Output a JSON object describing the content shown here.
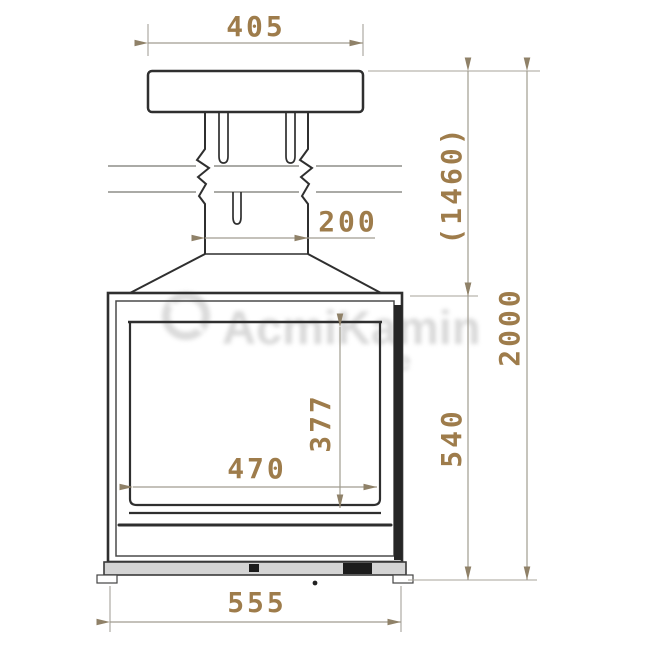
{
  "drawing": {
    "type": "fireplace-insert-front-elevation",
    "dimension_labels": {
      "top_plate_width": "405",
      "flue_width": "200",
      "ceiling_clearance": "(1460)",
      "overall_height": "2000",
      "firebox_height": "540",
      "glass_height": "377",
      "glass_width": "470",
      "firebox_width": "555"
    },
    "watermark": {
      "text": "AcmiKamin",
      "fragment": "e"
    },
    "colors": {
      "dimension_text": "#9e7c4b",
      "dimension_line": "#a09c90",
      "object_line": "#2f2f2f",
      "watermark": "#b9b9b9",
      "background": "#ffffff"
    }
  }
}
